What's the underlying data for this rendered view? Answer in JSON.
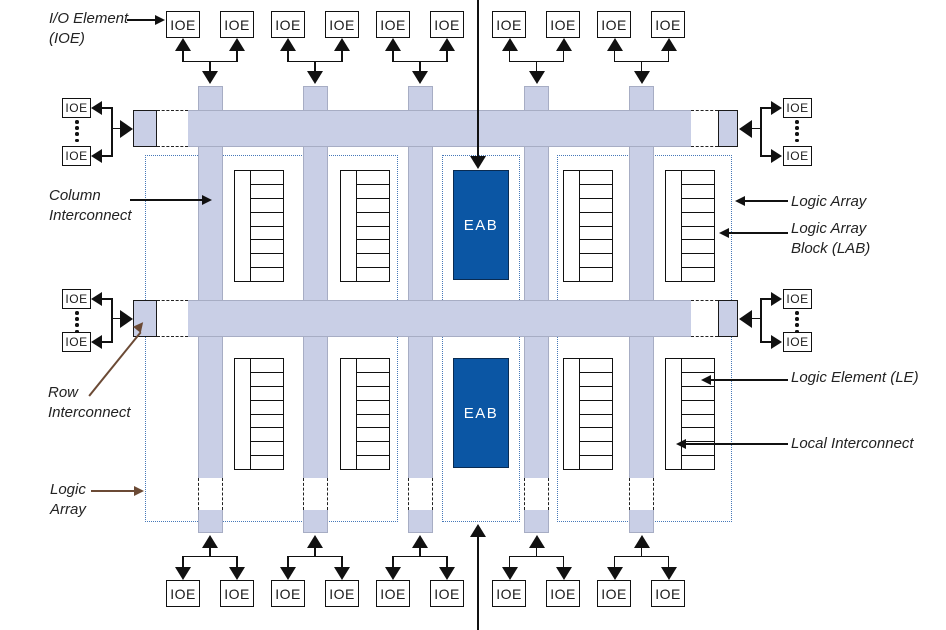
{
  "labels": {
    "ioe": "IOE",
    "eab": "EAB"
  },
  "annotations": {
    "io_element": {
      "line1": "I/O Element",
      "line2": "(IOE)"
    },
    "column_interconnect": {
      "line1": "Column",
      "line2": "Interconnect"
    },
    "row_interconnect": {
      "line1": "Row",
      "line2": "Interconnect"
    },
    "logic_array_left": {
      "line1": "Logic",
      "line2": "Array"
    },
    "logic_array_right": {
      "label": "Logic Array"
    },
    "logic_array_block": {
      "line1": "Logic Array",
      "line2": "Block (LAB)"
    },
    "logic_element": {
      "label": "Logic Element (LE)"
    },
    "local_interconnect": {
      "label": "Local Interconnect"
    }
  },
  "colors": {
    "interconnect_fill": "#c9cfe6",
    "eab_fill": "#0b56a4",
    "logic_array_dotted_border": "#4678b8",
    "annotation_arrow_brown": "#6b4a35",
    "line_black": "#111111"
  },
  "counts": {
    "top_ioe": 10,
    "bottom_ioe": 10,
    "left_ioe": 4,
    "right_ioe": 4,
    "row_interconnects": 2,
    "column_interconnects": 5,
    "labs": 8,
    "eabs": 2,
    "les_per_lab": 8
  }
}
